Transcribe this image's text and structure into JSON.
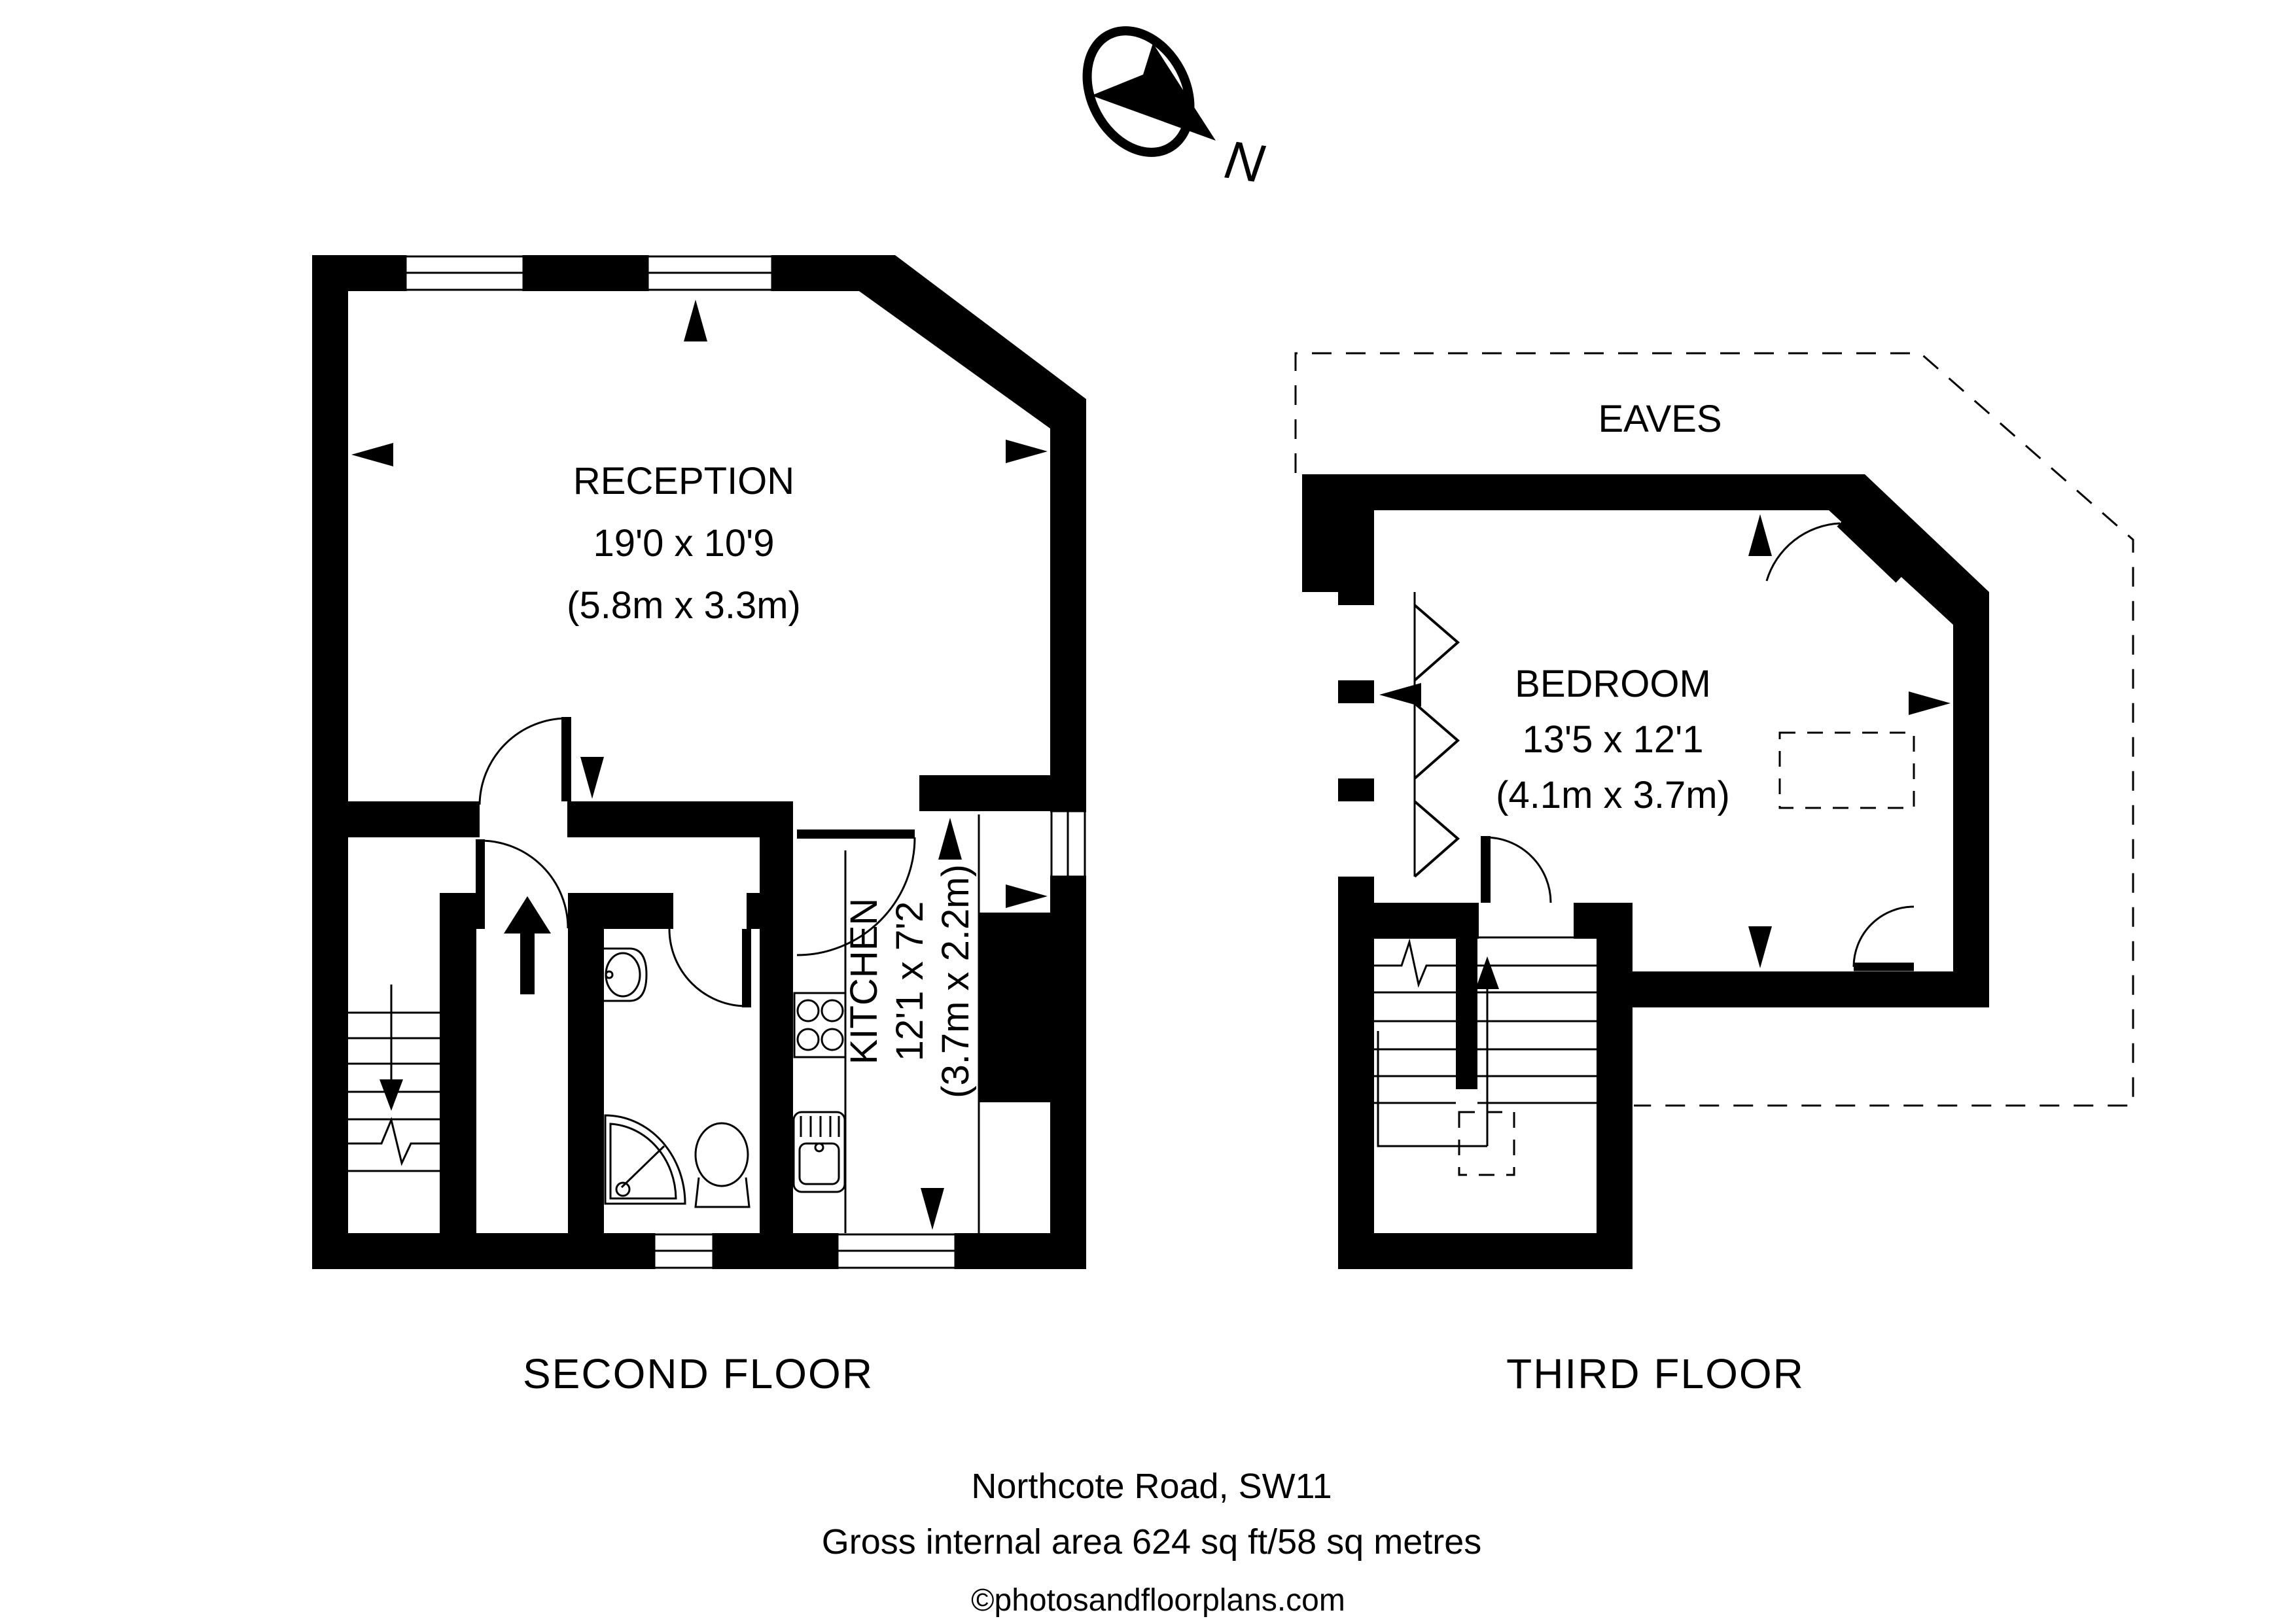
{
  "title": "Floor plan - Northcote Road, SW11",
  "compass": {
    "north_label": "N"
  },
  "second_floor": {
    "label": "SECOND FLOOR",
    "reception": {
      "name": "RECEPTION",
      "dimensions_imperial": "19'0 x 10'9",
      "dimensions_metric": "(5.8m x 3.3m)"
    },
    "kitchen": {
      "name": "KITCHEN",
      "dimensions_imperial": "12'1 x 7'2",
      "dimensions_metric": "(3.7m x 2.2m)"
    }
  },
  "third_floor": {
    "label": "THIRD FLOOR",
    "eaves_label": "EAVES",
    "bedroom": {
      "name": "BEDROOM",
      "dimensions_imperial": "13'5 x 12'1",
      "dimensions_metric": "(4.1m x 3.7m)"
    }
  },
  "footer": {
    "address": "Northcote Road, SW11",
    "area": "Gross internal area 624 sq ft/58 sq metres",
    "copyright": "©photosandfloorplans.com"
  },
  "colors": {
    "wall": "#000000",
    "background": "#ffffff"
  }
}
